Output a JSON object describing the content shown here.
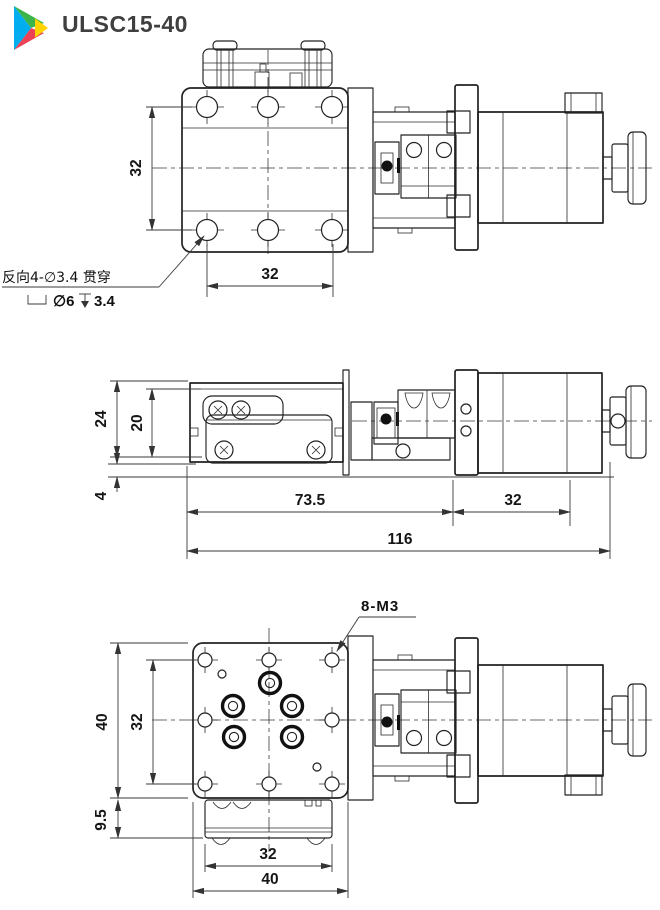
{
  "header": {
    "title": "ULSC15-40"
  },
  "logo": {
    "colors": {
      "blue": "#00AEEF",
      "green": "#3BB54A",
      "yellow": "#FFD400",
      "red": "#ED4156"
    }
  },
  "views": {
    "top": {
      "dim_hole_rows_spacing": "32",
      "dim_hole_cols_spacing": "32",
      "counterbore_note_line1": "反向4-∅3.4 贯穿",
      "counterbore_note_dia": "∅6",
      "counterbore_note_depth": "3.4"
    },
    "side": {
      "dim_overall_height": "24",
      "dim_table_height": "20",
      "dim_base_height": "4",
      "dim_stage_length": "73.5",
      "dim_motor_length": "32",
      "dim_overall_length": "116"
    },
    "bottom": {
      "thread_label": "8-M3",
      "dim_plate_height": "40",
      "dim_hole_rows_spacing": "32",
      "dim_connector_depth": "9.5",
      "dim_hole_cols_spacing": "32",
      "dim_plate_width": "40"
    }
  }
}
